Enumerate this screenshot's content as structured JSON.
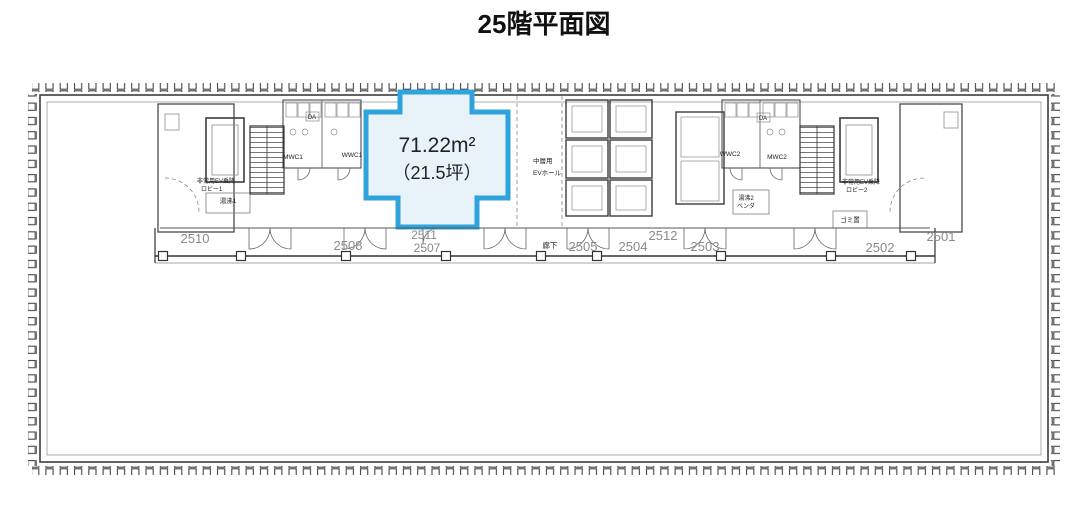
{
  "title": "25階平面図",
  "highlight": {
    "area_m2": "71.22m²",
    "area_tsubo": "（21.5坪）"
  },
  "rooms": [
    {
      "label": "2510"
    },
    {
      "label": "2508"
    },
    {
      "label": "2511"
    },
    {
      "label": "2507"
    },
    {
      "label": "2505"
    },
    {
      "label": "2504"
    },
    {
      "label": "2512"
    },
    {
      "label": "2503"
    },
    {
      "label": "2502"
    },
    {
      "label": "2501"
    }
  ],
  "labels": {
    "corridor": "廊下",
    "ev_hall_line1": "中層用",
    "ev_hall_line2": "EVホール",
    "lobby1_line1": "非常用EV乗降",
    "lobby1_line2": "ロビー1",
    "lobby2_line1": "非常用EV乗降",
    "lobby2_line2": "ロビー2",
    "mwc1": "MWC1",
    "wwc1": "WWC1",
    "wwc2": "WWC2",
    "mwc2": "MWC2",
    "hot_water1": "湯沸1",
    "hot_water2_line1": "湯沸2",
    "hot_water2_line2": "ベンダ",
    "garbage": "ゴミ置",
    "duct": "DA"
  },
  "colors": {
    "highlight_stroke": "#2FA3DC",
    "highlight_fill": "#E7F2F9",
    "room_number": "#8a8a8a"
  }
}
